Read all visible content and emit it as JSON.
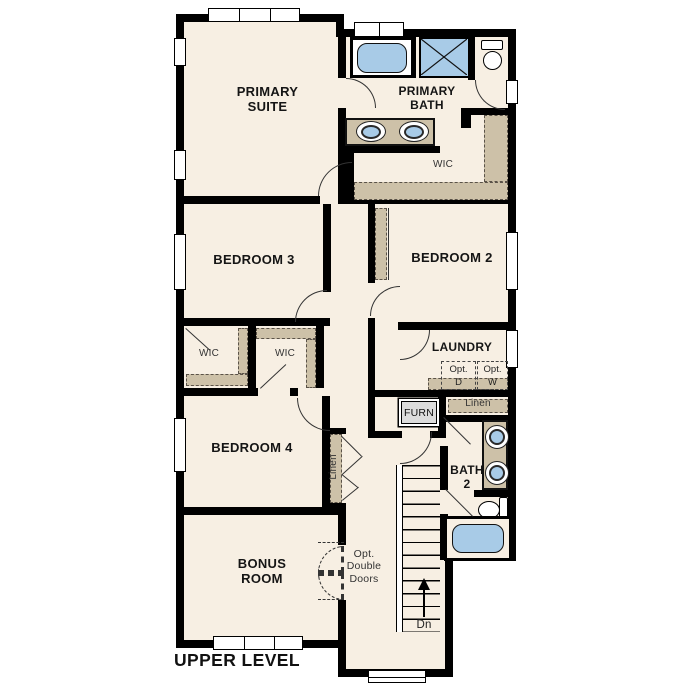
{
  "plan": {
    "title": "UPPER LEVEL",
    "rooms": {
      "primary_suite": "PRIMARY\nSUITE",
      "primary_bath": "PRIMARY\nBATH",
      "wic_primary": "WIC",
      "bedroom3": "BEDROOM 3",
      "bedroom2": "BEDROOM 2",
      "laundry": "LAUNDRY",
      "wic_bedroom3": "WIC",
      "wic_bedroom4": "WIC",
      "bedroom4": "BEDROOM 4",
      "bath2": "BATH\n2",
      "bonus_room": "BONUS\nROOM"
    },
    "labels": {
      "furnace": "FURN",
      "linen_hall": "Linen",
      "linen_bedroom4": "Linen",
      "opt_dryer": "Opt.",
      "opt_dryer_letter": "D",
      "opt_washer": "Opt.",
      "opt_washer_letter": "W",
      "opt_double_doors": "Opt.\nDouble\nDoors",
      "stairs_down": "Dn"
    },
    "colors": {
      "floor": "#f7efe3",
      "wall": "#000000",
      "casework": "#cdc1a8",
      "fixture_blue": "#a8cbe7",
      "text": "#151515"
    }
  }
}
